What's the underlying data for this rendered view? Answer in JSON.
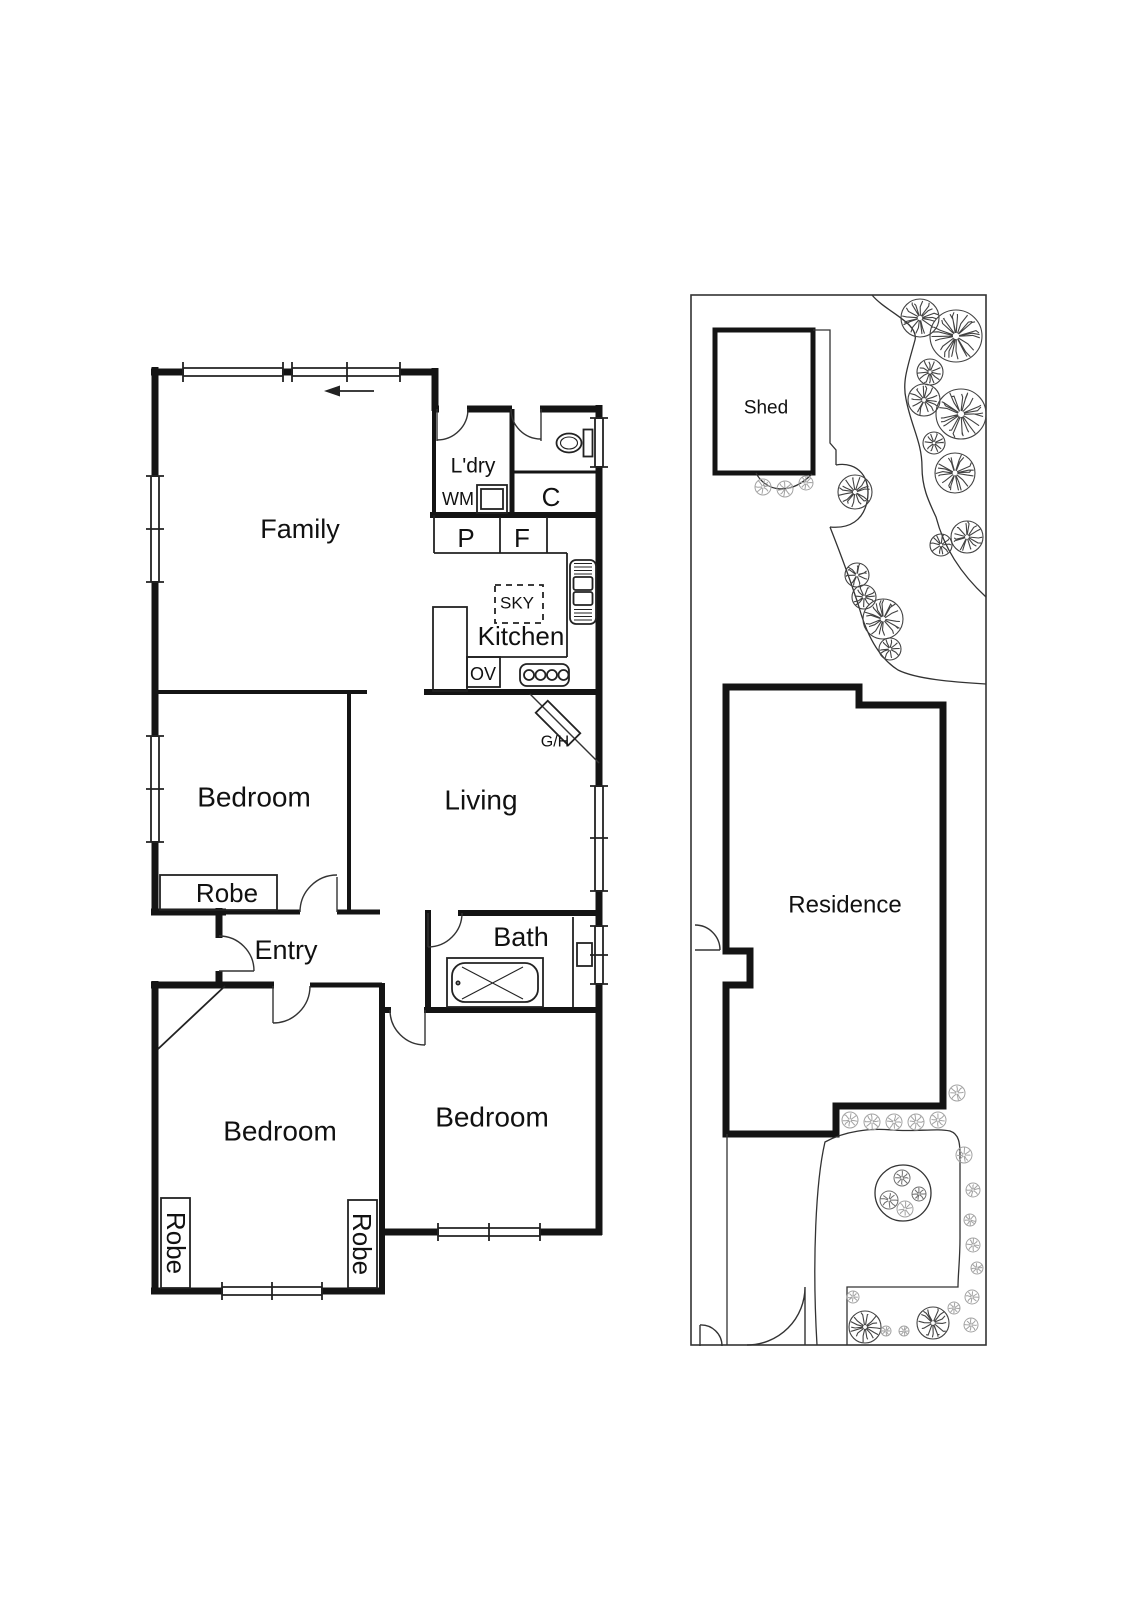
{
  "ink": "#141414",
  "floor_plan": {
    "rooms": {
      "family": "Family",
      "laundry": "L'dry",
      "kitchen": "Kitchen",
      "living": "Living",
      "bedroom_left": "Bedroom",
      "entry": "Entry",
      "bath": "Bath",
      "bedroom_bottom_right": "Bedroom",
      "bedroom_bottom_left": "Bedroom"
    },
    "fixtures": {
      "washing_machine": "WM",
      "cupboard": "C",
      "pantry": "P",
      "fridge": "F",
      "skylight": "SKY",
      "oven": "OV",
      "gas_heater": "G/H"
    },
    "robes": {
      "bedroom_left": "Robe",
      "bottom_left_west": "Robe",
      "bottom_left_east": "Robe"
    }
  },
  "site_plan": {
    "shed": "Shed",
    "residence": "Residence"
  }
}
